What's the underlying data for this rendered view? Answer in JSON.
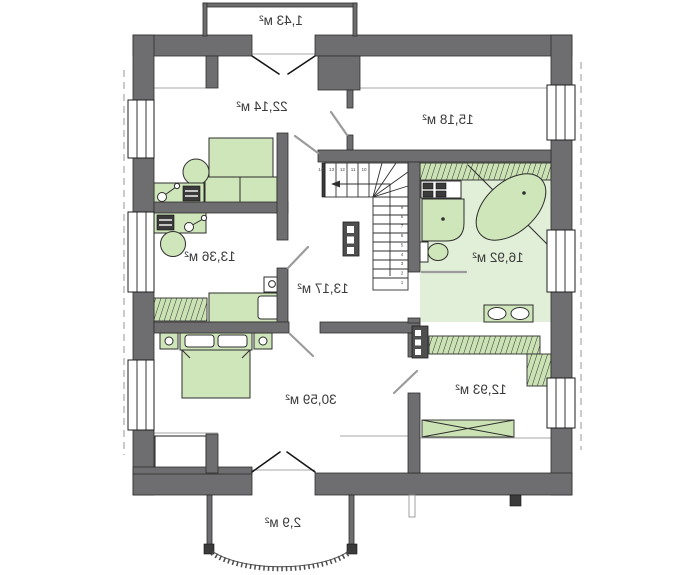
{
  "plan": {
    "type": "floor-plan",
    "rooms": [
      {
        "id": "balcony-top",
        "area": "1,43 м²"
      },
      {
        "id": "living-room",
        "area": "22,14 м²"
      },
      {
        "id": "bedroom-top-right",
        "area": "15,18 м²"
      },
      {
        "id": "room-left-middle",
        "area": "13,36 м²"
      },
      {
        "id": "hall-stairs",
        "area": "13,17 м²"
      },
      {
        "id": "bathroom",
        "area": "16,92 м²"
      },
      {
        "id": "bedroom-master",
        "area": "30,59 м²"
      },
      {
        "id": "wardrobe-room",
        "area": "12,93 м²"
      },
      {
        "id": "balcony-bottom",
        "area": "2,9 м²"
      }
    ],
    "stairs": {
      "step_numbers": [
        "1",
        "2",
        "3",
        "4",
        "5",
        "6",
        "7",
        "8",
        "9",
        "10",
        "11",
        "12",
        "13",
        "14"
      ]
    },
    "colors": {
      "wall": "#6e6e70",
      "line": "#2e2e2e",
      "furniture": "#cfe5ba",
      "hatch": "#cbe2b4",
      "bath_floor": "#e2efd8",
      "label": "#3a3a3a",
      "door_swing": "#9b9b9b",
      "eave": "#b5b5b5"
    },
    "text_mirrored": true
  }
}
